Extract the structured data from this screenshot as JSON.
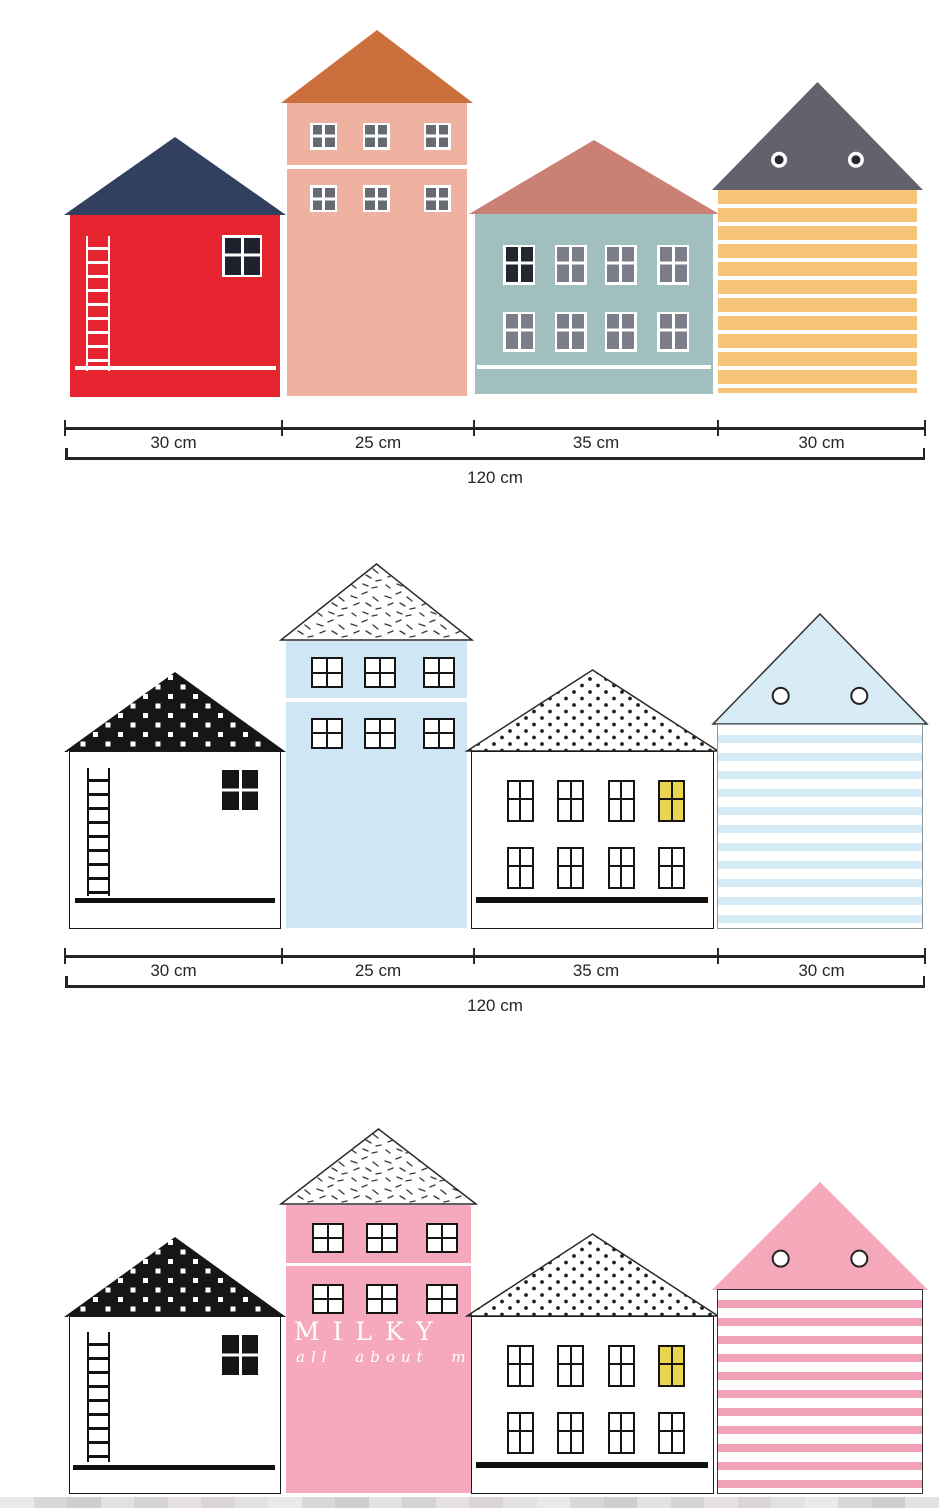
{
  "palette": {
    "ink": "#262626",
    "frame_black": "#151515",
    "white": "#ffffff",
    "yellow_window": "#e9d54e"
  },
  "rulers": [
    {
      "segments": [
        "30 cm",
        "25 cm",
        "35 cm",
        "30 cm"
      ],
      "total": "120 cm"
    },
    {
      "segments": [
        "30 cm",
        "25 cm",
        "35 cm",
        "30 cm"
      ],
      "total": "120 cm"
    }
  ],
  "watermark": {
    "line1": "MILKY",
    "line2": "all about my"
  },
  "rows": [
    {
      "name": "row-colorful-houses",
      "houses": [
        {
          "kind": "ladder",
          "name": "red-house-navy-roof",
          "body": "#e62430",
          "roof": {
            "fill": "#31405f"
          },
          "ladder": "#ffffff",
          "line": "#ffffff",
          "win": {
            "style": "whiteframe",
            "pane": "#1d222e"
          }
        },
        {
          "kind": "tall",
          "name": "salmon-house-orange-roof",
          "body": "#efb2a0",
          "roof": {
            "fill": "#cb6f3c"
          },
          "line": "#ffffff",
          "win": {
            "style": "whiteframe",
            "pane": "#686a72"
          }
        },
        {
          "kind": "wide",
          "name": "teal-house-rose-roof",
          "body": "#a2bfc0",
          "roof": {
            "fill": "#ca8074"
          },
          "line": "#ffffff",
          "win": {
            "style": "whiteframe",
            "pane": "#7b7e88",
            "first_pane": "#232730"
          }
        },
        {
          "kind": "striped",
          "name": "orange-striped-house-gray-roof",
          "body": "#f5c478",
          "stripe_mode": "white-on-color",
          "roof": {
            "fill": "#62626c",
            "circles": "ring",
            "circle_dark": "#26262e"
          }
        }
      ]
    },
    {
      "name": "row-blue-houses",
      "houses": [
        {
          "kind": "ladder",
          "name": "white-house-black-dotted-roof",
          "body": "#ffffff",
          "outline": "#1a1a1a",
          "roof": {
            "pattern": "whitesq"
          },
          "ladder": "#111111",
          "line": "#111111",
          "win": {
            "style": "solidblack"
          }
        },
        {
          "kind": "tall",
          "name": "lightblue-house-sprinkle-roof",
          "body": "#cfe7f5",
          "roof": {
            "pattern": "sprinkle",
            "stroke": "#2a2a2a"
          },
          "line": "#ffffff",
          "win": {
            "style": "blackframe",
            "pane": "#ffffff"
          }
        },
        {
          "kind": "wide",
          "name": "white-house-polkadot-roof",
          "body": "#ffffff",
          "outline": "#1a1a1a",
          "roof": {
            "pattern": "polka",
            "stroke": "#2a2a2a"
          },
          "line": "#111111",
          "win": {
            "style": "blackframe",
            "pane": "#ffffff",
            "accent_pane": "#e9d54e",
            "accent_index": 3
          }
        },
        {
          "kind": "striped",
          "name": "blue-striped-house-blue-roof",
          "body": "#ffffff",
          "stripe": "#d7eaf7",
          "stripe_mode": "color-on-white",
          "outline": "#8a9aa5",
          "roof": {
            "fill": "#d8ecf8",
            "stroke": "#333333",
            "circles": "outline"
          }
        }
      ]
    },
    {
      "name": "row-pink-houses",
      "houses": [
        {
          "kind": "ladder",
          "name": "white-house-black-dotted-roof",
          "body": "#ffffff",
          "outline": "#1a1a1a",
          "roof": {
            "pattern": "whitesq"
          },
          "ladder": "#111111",
          "line": "#111111",
          "win": {
            "style": "solidblack"
          }
        },
        {
          "kind": "tall",
          "name": "pink-house-sprinkle-roof",
          "body": "#f6a9bd",
          "roof": {
            "pattern": "sprinkle",
            "stroke": "#2a2a2a"
          },
          "line": "#ffffff",
          "win": {
            "style": "blackframe",
            "pane": "#ffffff"
          },
          "watermark": true
        },
        {
          "kind": "wide",
          "name": "white-house-polkadot-roof",
          "body": "#ffffff",
          "outline": "#1a1a1a",
          "roof": {
            "pattern": "polka",
            "stroke": "#2a2a2a"
          },
          "line": "#111111",
          "win": {
            "style": "blackframe",
            "pane": "#ffffff",
            "accent_pane": "#e9d54e",
            "accent_index": 3
          }
        },
        {
          "kind": "striped",
          "name": "pink-striped-house-pink-roof",
          "body": "#ffffff",
          "stripe": "#f1a2b6",
          "stripe_mode": "color-on-white",
          "outline": "#333333",
          "roof": {
            "fill": "#f4a8ba",
            "circles": "outline"
          }
        }
      ]
    }
  ],
  "bottom_artifact_colors": [
    "#e7e7e7",
    "#d2d2d4",
    "#c6c6c8",
    "#dedede",
    "#cfcccd",
    "#e3dcde",
    "#d6ced0",
    "#dddddd"
  ]
}
